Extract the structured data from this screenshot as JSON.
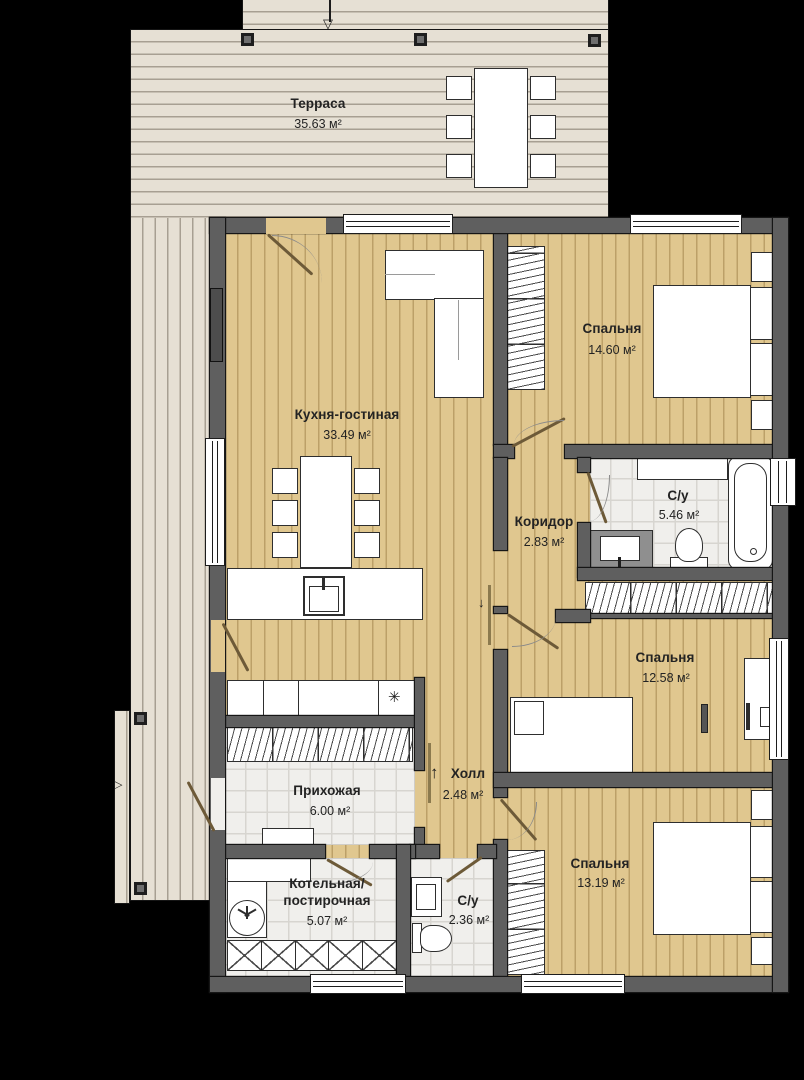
{
  "rooms": {
    "terrace": {
      "name": "Терраса",
      "area": "35.63 м²"
    },
    "kitchen_living": {
      "name": "Кухня-гостиная",
      "area": "33.49 м²"
    },
    "bedroom_top": {
      "name": "Спальня",
      "area": "14.60 м²"
    },
    "bathroom_main": {
      "name": "С/у",
      "area": "5.46 м²"
    },
    "corridor": {
      "name": "Коридор",
      "area": "2.83 м²"
    },
    "bedroom_middle": {
      "name": "Спальня",
      "area": "12.58 м²"
    },
    "hall": {
      "name": "Холл",
      "area": "2.48 м²"
    },
    "entry": {
      "name": "Прихожая",
      "area": "6.00 м²"
    },
    "boiler_laundry": {
      "name_line1": "Котельная/",
      "name_line2": "постирочная",
      "area": "5.07 м²"
    },
    "bathroom_small": {
      "name": "С/у",
      "area": "2.36 м²"
    },
    "bedroom_bottom": {
      "name": "Спальня",
      "area": "13.19 м²"
    }
  },
  "icons": {
    "entry_arrow_top": "▽",
    "entry_arrow_side": "▷",
    "hall_arrow_up": "↑",
    "opening_arrow_down": "↓",
    "hob_symbol": "✳"
  },
  "colors": {
    "floor_wood": "#e0c78f",
    "deck": "#e6e0d4",
    "wall": "#5f5f5f",
    "tile": "#f0efec",
    "furniture": "#ffffff",
    "label_text": "#232323",
    "door_leaf": "#6d5a38",
    "background": "#000000"
  }
}
